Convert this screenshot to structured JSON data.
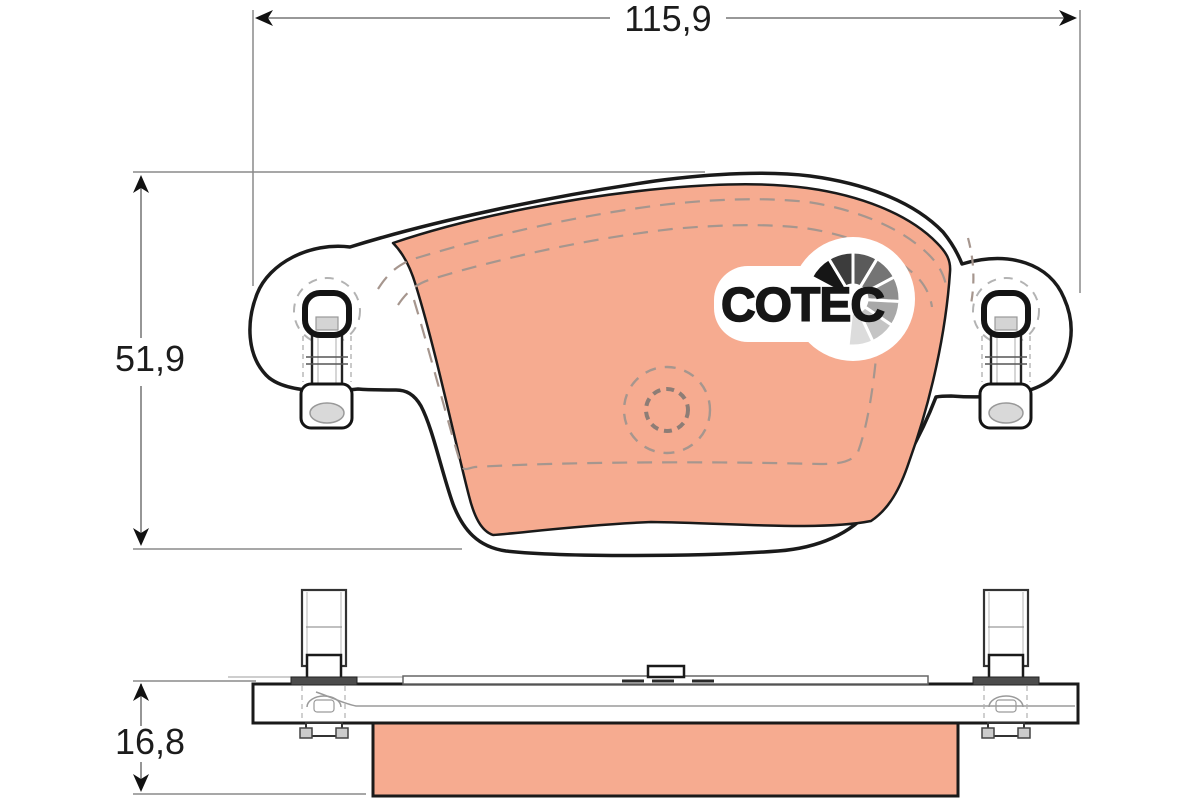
{
  "drawing": {
    "type": "brake-pad-technical-drawing",
    "views": [
      "front-view",
      "side-view"
    ]
  },
  "dimensions": {
    "width_mm": "115,9",
    "height_mm": "51,9",
    "thickness_mm": "16,8"
  },
  "logo": {
    "text": "COTEC",
    "fan_icon": "cotec-fan-icon"
  },
  "colors": {
    "friction": "#f6ab90",
    "outline": "#1a1a1a",
    "dimension_lines": "#8a8a8a",
    "hidden_lines": "#a6968e",
    "clip_flange": "#4c4c4c",
    "fan_shades": [
      "#161616",
      "#3c3c3c",
      "#5a5a5a",
      "#747474",
      "#8e8e8e",
      "#a8a8a8",
      "#c4c4c4",
      "#dcdcdc"
    ]
  }
}
